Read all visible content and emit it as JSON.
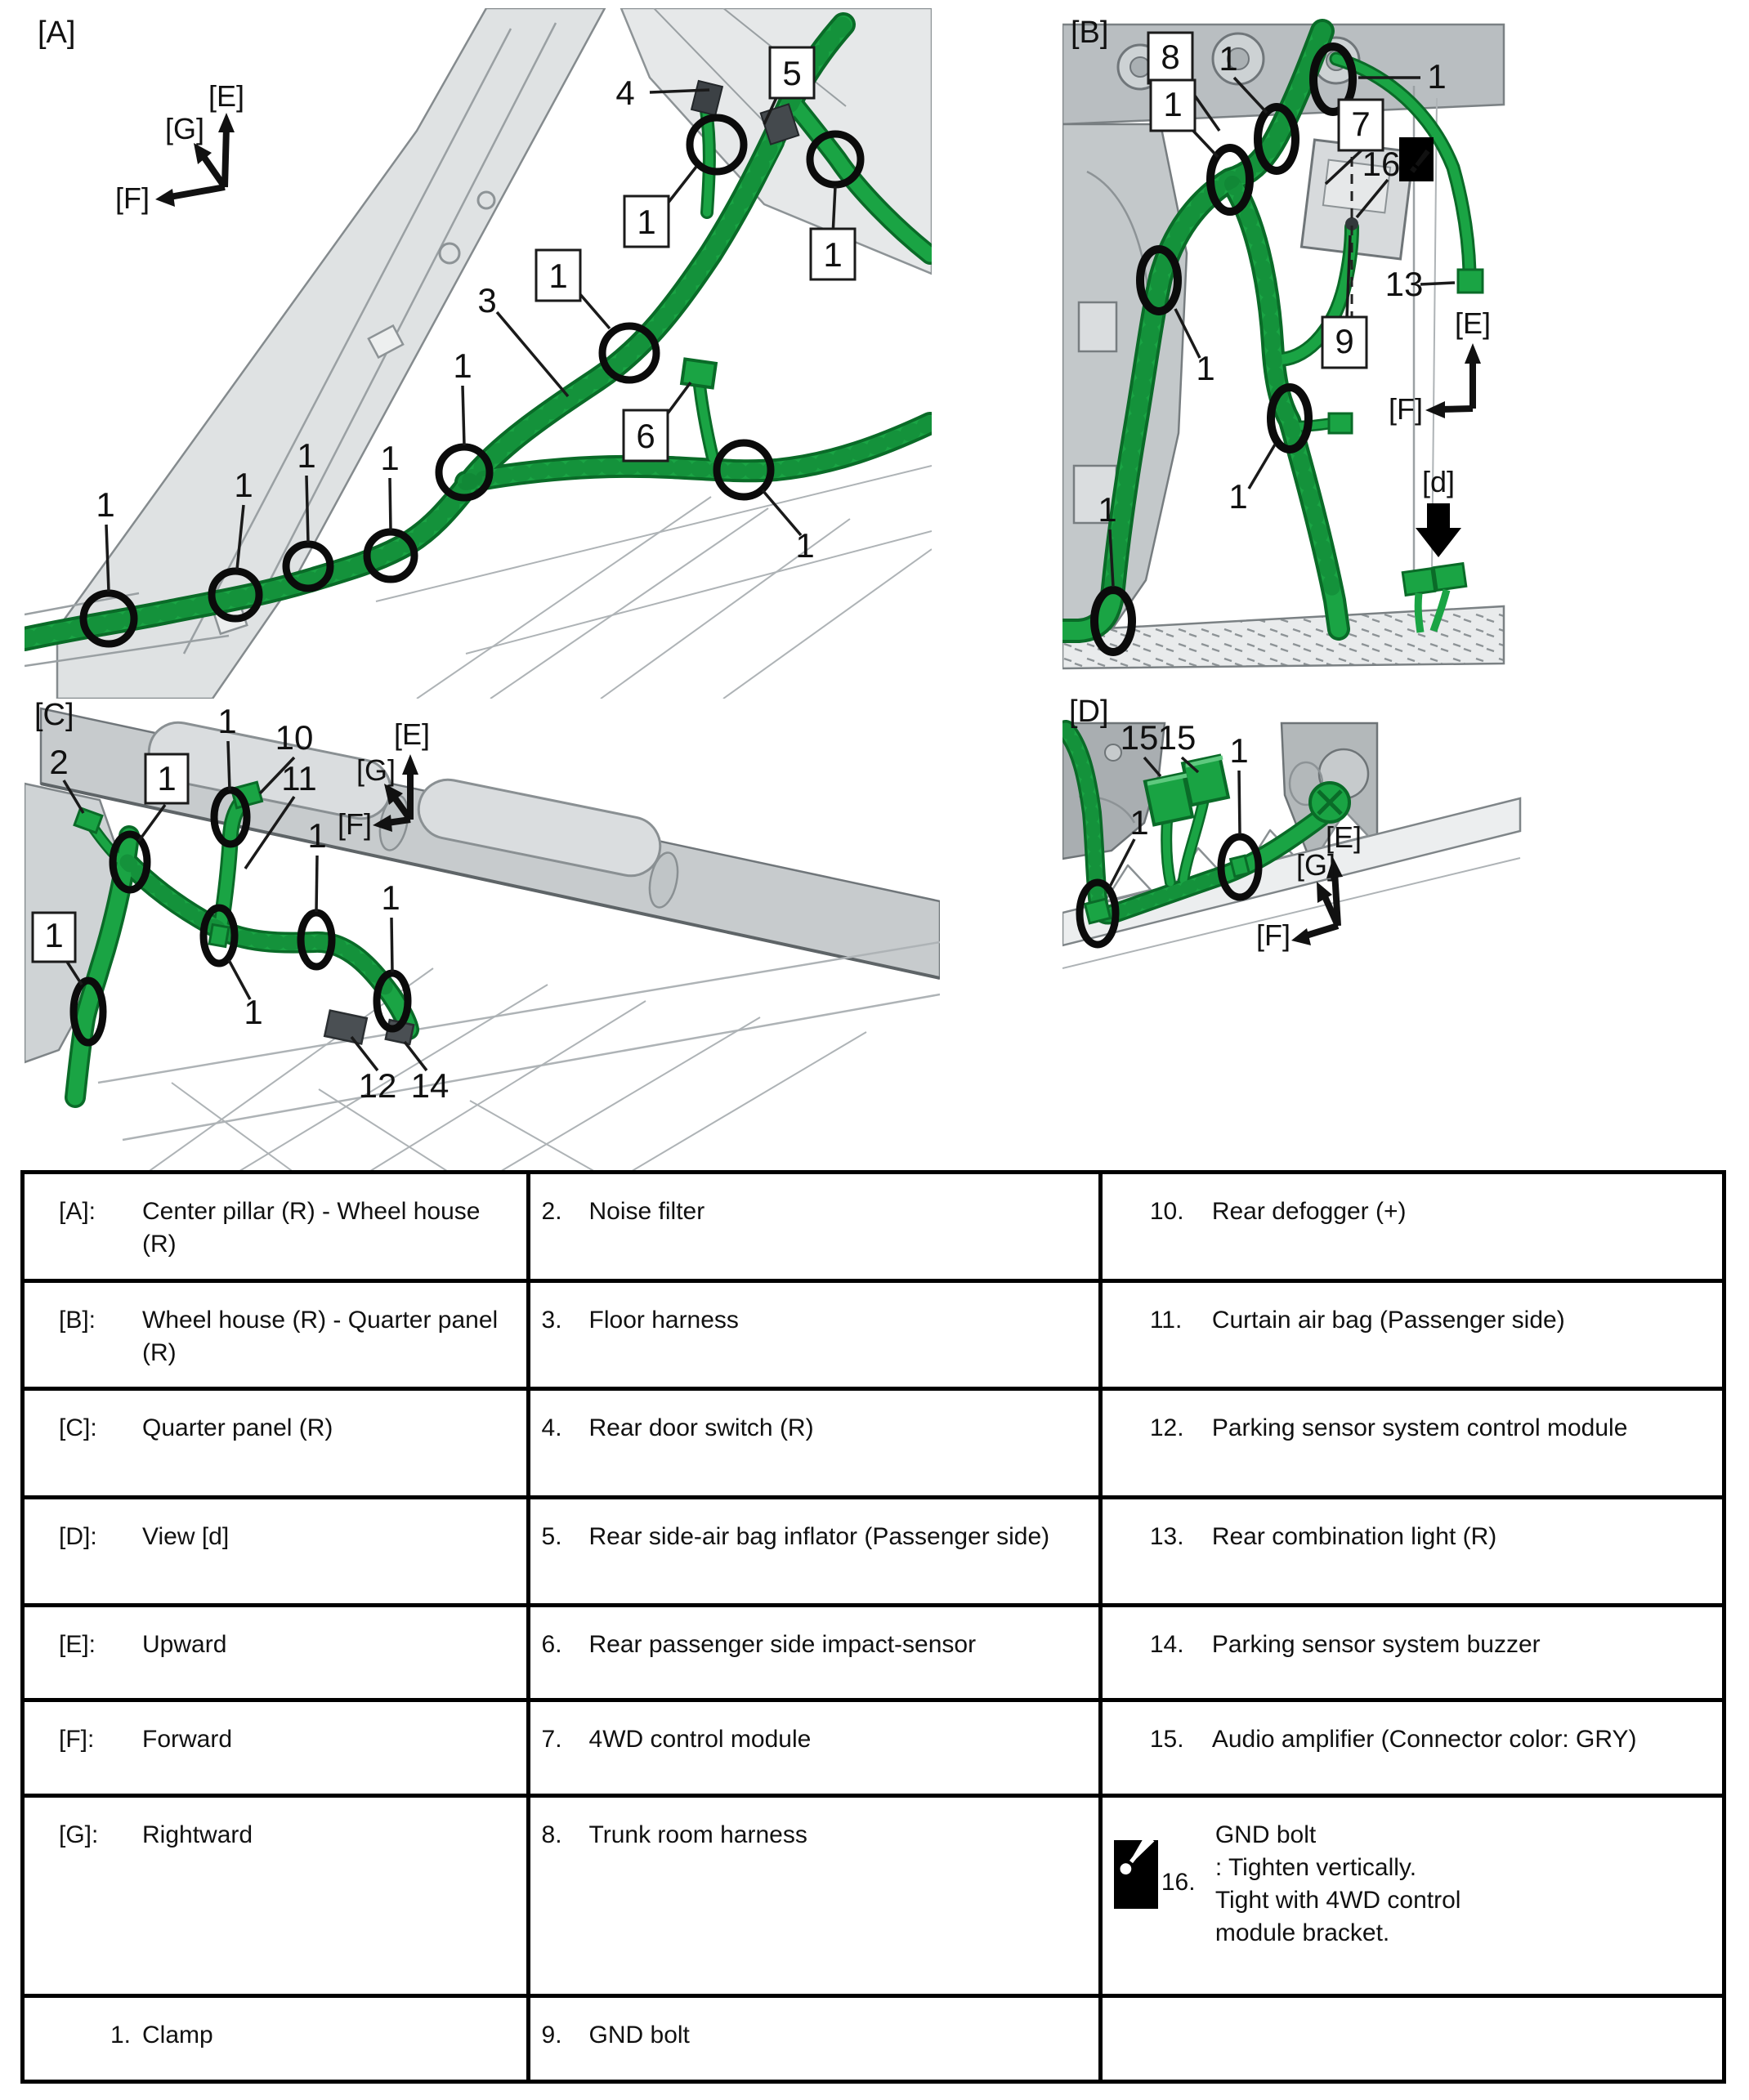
{
  "icons": {
    "warning_glyph": "!"
  },
  "colors": {
    "harness_green": "#1AA444",
    "harness_dark": "#0A6B28",
    "panel_light": "#E8EAEB",
    "panel_mid": "#CDD1D3",
    "panel_dark": "#A9AEB1",
    "outline": "#70767A",
    "callout_black": "#111111"
  },
  "panels": {
    "a": {
      "labels": [
        "[A]",
        "[E]",
        "[G]",
        "[F]",
        "4",
        "5",
        "1",
        "3",
        "6",
        "1",
        "1",
        "1",
        "1",
        "1",
        "1",
        "1",
        "1"
      ]
    },
    "b": {
      "labels": [
        "[B]",
        "8",
        "1",
        "1",
        "1",
        "7",
        "16",
        "13",
        "9",
        "1",
        "1",
        "1",
        "[E]",
        "[F]",
        "[d]"
      ]
    },
    "c": {
      "labels": [
        "[C]",
        "2",
        "1",
        "1",
        "10",
        "11",
        "1",
        "1",
        "1",
        "1",
        "12",
        "14",
        "[E]",
        "[G]",
        "[F]"
      ]
    },
    "d": {
      "labels": [
        "[D]",
        "15",
        "15",
        "1",
        "1",
        "[E]",
        "[G]",
        "[F]"
      ]
    }
  },
  "table": {
    "rows": [
      {
        "c1k": "[A]:",
        "c1v": "Center pillar (R) - Wheel house (R)",
        "c2n": "2.",
        "c2v": "Noise filter",
        "c3n": "10.",
        "c3v": "Rear defogger (+)"
      },
      {
        "c1k": "[B]:",
        "c1v": "Wheel house (R) - Quarter panel (R)",
        "c2n": "3.",
        "c2v": "Floor harness",
        "c3n": "11.",
        "c3v": "Curtain air bag (Passenger side)"
      },
      {
        "c1k": "[C]:",
        "c1v": "Quarter panel (R)",
        "c2n": "4.",
        "c2v": "Rear door switch (R)",
        "c3n": "12.",
        "c3v": "Parking sensor system control module"
      },
      {
        "c1k": "[D]:",
        "c1v": "View [d]",
        "c2n": "5.",
        "c2v": "Rear side-air bag inflator (Passenger side)",
        "c3n": "13.",
        "c3v": "Rear combination light (R)"
      },
      {
        "c1k": "[E]:",
        "c1v": "Upward",
        "c2n": "6.",
        "c2v": "Rear passenger side impact-sensor",
        "c3n": "14.",
        "c3v": "Parking sensor system buzzer"
      },
      {
        "c1k": "[F]:",
        "c1v": "Forward",
        "c2n": "7.",
        "c2v": "4WD control module",
        "c3n": "15.",
        "c3v": "Audio amplifier (Connector color: GRY)"
      },
      {
        "c1k": "[G]:",
        "c1v": "Rightward",
        "c2n": "8.",
        "c2v": "Trunk room harness",
        "c3n": "16.",
        "c3v": "GND bolt\n: Tighten vertically.\nTight with 4WD control\nmodule bracket."
      },
      {
        "c1k": "1.",
        "c1v": "Clamp",
        "c2n": "9.",
        "c2v": "GND bolt",
        "c3n": "",
        "c3v": ""
      }
    ]
  }
}
